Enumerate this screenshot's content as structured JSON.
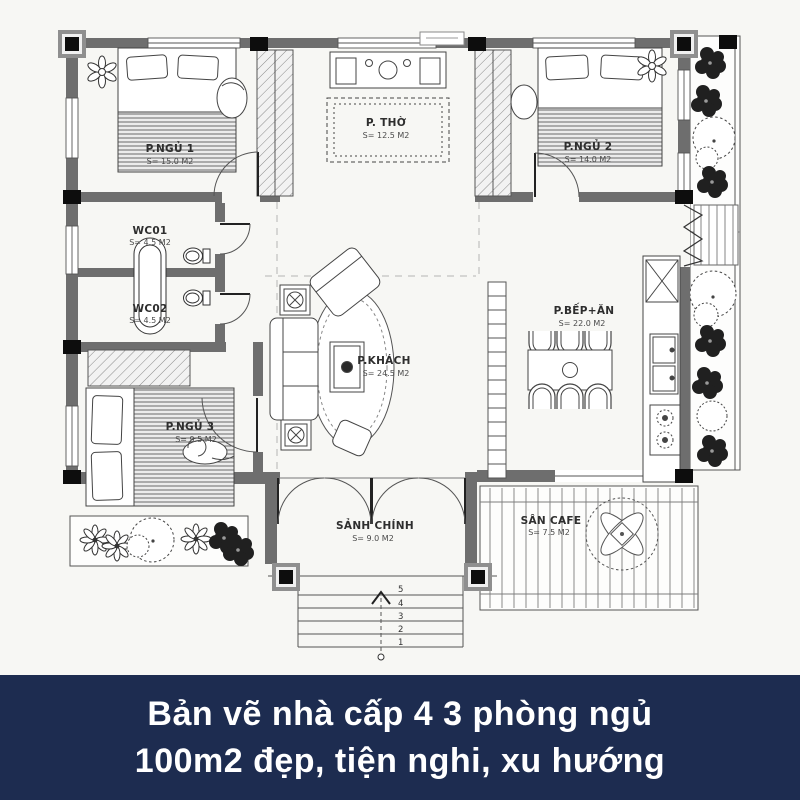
{
  "caption": {
    "line1": "Bản vẽ nhà cấp 4 3 phòng ngủ",
    "line2": "100m2 đẹp, tiện nghi, xu hướng",
    "background": "#1d2c50",
    "text_color": "#ffffff"
  },
  "plan": {
    "wall_color": "#6e6e6e",
    "line_color": "#444444",
    "paper_color": "#f7f7f4",
    "rooms": [
      {
        "name": "bedroom-1",
        "label": "P.NGỦ 1",
        "area": "S= 15.0 M2"
      },
      {
        "name": "worship-room",
        "label": "P. THỜ",
        "area": "S= 12.5 M2"
      },
      {
        "name": "bedroom-2",
        "label": "P.NGỦ 2",
        "area": "S= 14.0 M2"
      },
      {
        "name": "wc-01",
        "label": "WC01",
        "area": "S= 4.5 M2"
      },
      {
        "name": "wc-02",
        "label": "WC02",
        "area": "S= 4.5 M2"
      },
      {
        "name": "bedroom-3",
        "label": "P.NGỦ 3",
        "area": "S= 9.5 M2"
      },
      {
        "name": "living-room",
        "label": "P.KHÁCH",
        "area": "S= 24.5 M2"
      },
      {
        "name": "kitchen-dining",
        "label": "P.BẾP+ĂN",
        "area": "S= 22.0 M2"
      },
      {
        "name": "main-hall",
        "label": "SẢNH CHÍNH",
        "area": "S= 9.0 M2"
      },
      {
        "name": "cafe-terrace",
        "label": "SÂN CAFE",
        "area": "S= 7.5 M2"
      }
    ],
    "stair_steps": [
      "5",
      "4",
      "3",
      "2",
      "1"
    ]
  }
}
